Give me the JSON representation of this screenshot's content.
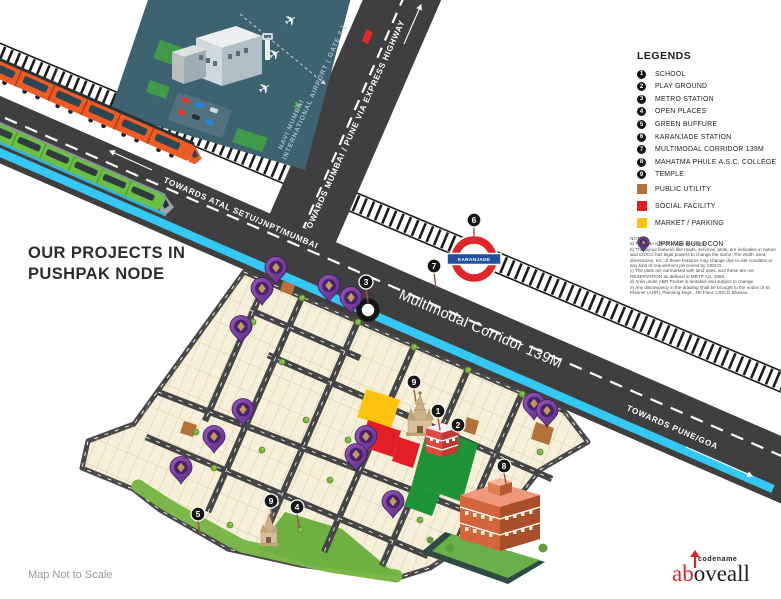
{
  "title": {
    "line1": "OUR PROJECTS IN",
    "line2": "PUSHPAK NODE"
  },
  "legend": {
    "heading": "LEGENDS",
    "numbered": [
      {
        "num": "1",
        "label": "SCHOOL"
      },
      {
        "num": "2",
        "label": "PLAY GROUND"
      },
      {
        "num": "3",
        "label": "METRO STATION"
      },
      {
        "num": "4",
        "label": "OPEN PLACES"
      },
      {
        "num": "5",
        "label": "GREEN BUFFURE"
      },
      {
        "num": "6",
        "label": "KARANJADE STATION"
      },
      {
        "num": "7",
        "label": "MULTIMODAL CORRIDOR 139M"
      },
      {
        "num": "8",
        "label": "MAHATMA PHULE A.S.C. COLLEGE"
      },
      {
        "num": "9",
        "label": "TEMPLE"
      }
    ],
    "zones": [
      {
        "color": "#b4713a",
        "label": "PUBLIC UTILITY"
      },
      {
        "color": "#e31e24",
        "label": "SOCIAL FACILITY"
      },
      {
        "color": "#ffc20d",
        "label": "MARKET / PARKING"
      }
    ],
    "pin_label": "JPRIME BUILDCON"
  },
  "notes": "NOTES:\na) This plan is NOT a legal document.\nb) The layout features like roads, services, plots, are indicative in nature and CIDCO has legal powers to change the same. The width, area, dimensions, etc. of these features may change due to site condition or any kind of requirement perceived by CIDCO.\nc) The plots are earmarked with land uses, and these are not RESERVATION as defined in MRTP Act, 1966.\nd) Area under ABR Pocket is tentative and subject to change.\ne) Any discrepancy in the drawing shall be brought to the notice of Sr. Planner (AHR), Planning Dept., 4th Floor, CIDCO Bhavan.",
  "roads": {
    "towards_mumbai": "TOWARDS ATAL SETU/JNPT/MUMBAI",
    "corridor_label": "Multimodal Corridor 139M",
    "towards_pune": "TOWARDS PUNE/GOA",
    "towards_express": "TOWARDS MUMBAI / PUNE  VIA EXPRESS HIGHWAY",
    "airport_line1": "NAVI MUMBAI",
    "airport_line2": "INTERNATIONAL AIRPORT ( GATE 2 )",
    "station_roundel": "KARANJADE"
  },
  "map_markers": [
    {
      "n": "3"
    },
    {
      "n": "7"
    },
    {
      "n": "6"
    },
    {
      "n": "9"
    },
    {
      "n": "1"
    },
    {
      "n": "2"
    },
    {
      "n": "8"
    },
    {
      "n": "9"
    },
    {
      "n": "4"
    },
    {
      "n": "5"
    }
  ],
  "footer": {
    "scale_note": "Map Not to Scale",
    "logo_small": "codename",
    "logo_red": "ab",
    "logo_black": "oveall"
  },
  "colors": {
    "road": "#3f3f3f",
    "metro_line": "#35c8f5",
    "plot_fill": "#f6efda",
    "playground_green": "#1e9237",
    "buffer_green": "#7ab648",
    "public_utility": "#b4713a",
    "social_facility": "#e31e24",
    "market_parking": "#ffc20d",
    "jprime_purple": "#6f3795",
    "panel_teal": "#3d6270"
  }
}
